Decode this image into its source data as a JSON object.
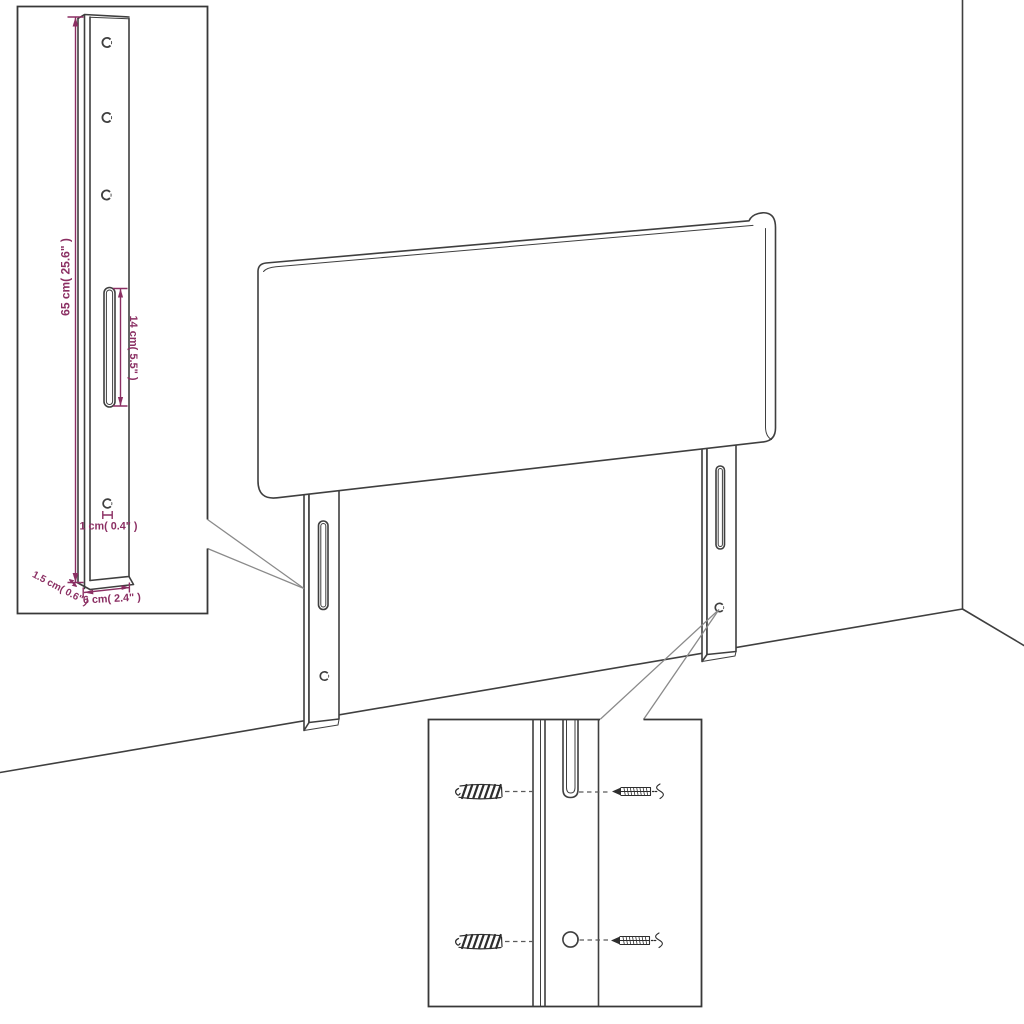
{
  "diagram": {
    "name": "Headboard with mounting legs - assembly dimension diagram",
    "colors": {
      "line": "#3f3f3f",
      "dimension": "#8b2f63",
      "callout": "#8a8a8a",
      "background": "#ffffff"
    },
    "leg_detail": {
      "height_label": "65 cm( 25.6\" )",
      "slot_length_label": "14 cm( 5.5\" )",
      "hole_diameter_label": "1 cm( 0.4\" )",
      "depth_label": "1.5 cm( 0.6\" )",
      "width_label": "6 cm( 2.4\" )"
    }
  }
}
